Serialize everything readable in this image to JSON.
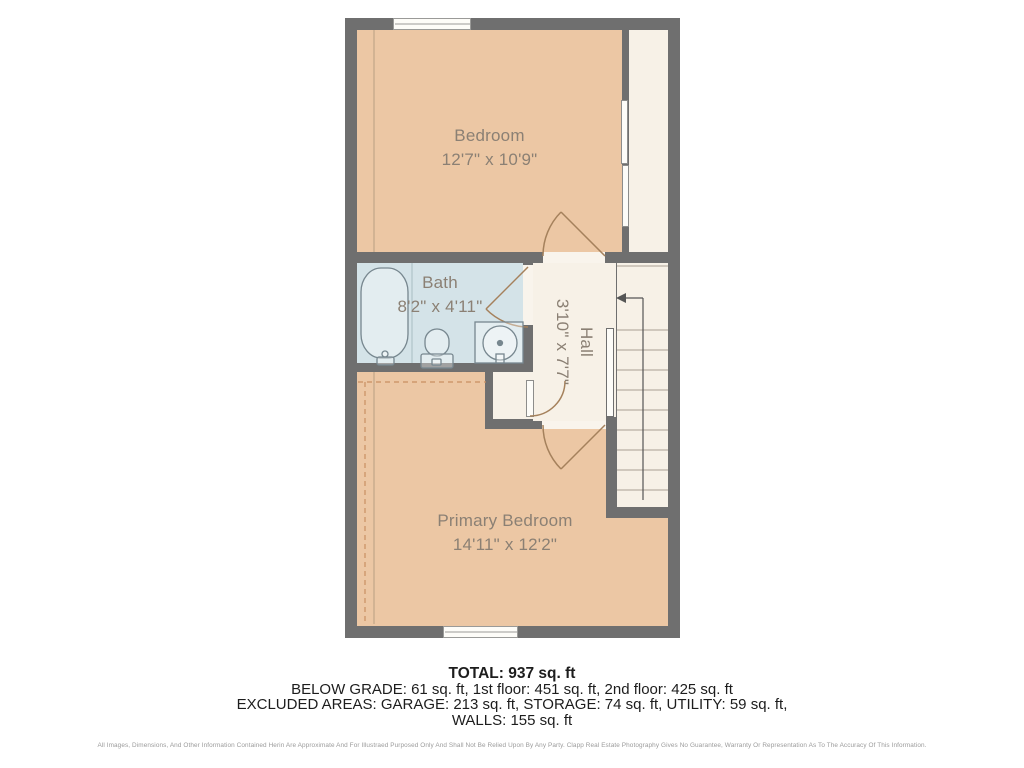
{
  "floor_plan": {
    "rooms": [
      {
        "name": "Bedroom",
        "dims": "12'7\" x 10'9\""
      },
      {
        "name": "Bath",
        "dims": "8'2\" x 4'11\""
      },
      {
        "name": "Hall",
        "dims": "3'10\" x 7'7\""
      },
      {
        "name": "Primary Bedroom",
        "dims": "14'11\" x 12'2\""
      }
    ],
    "features": [
      "stairs-with-up-arrow",
      "two-windows",
      "closet-sliding-doors",
      "bathtub",
      "toilet",
      "vanity-sink"
    ]
  },
  "summary": {
    "total": "TOTAL: 937 sq. ft",
    "floors": "BELOW GRADE: 61 sq. ft, 1st floor: 451 sq. ft, 2nd floor: 425 sq. ft",
    "excluded": "EXCLUDED AREAS: GARAGE: 213 sq. ft, STORAGE: 74 sq. ft, UTILITY: 59 sq. ft,",
    "walls": "WALLS: 155 sq. ft"
  },
  "disclaimer": "All Images, Dimensions, And Other Information Contained Herin Are Approximate And For Illustraed Purposed Only And Shall Not Be Relied Upon By Any Party. Clapp Real Estate Photography Gives No Guarantee, Warranty Or Representation As To The Accuracy Of This Information.",
  "colors": {
    "wall": "#6f6f6f",
    "bedroom_fill": "#ecc7a4",
    "bath_fill": "#d4e3e8",
    "hall_fill": "#f7f1e7",
    "door_arc": "#a5815c",
    "closet_dashed": "#c98f62",
    "label_text": "#8b8074",
    "summary_text": "#1d1d1d",
    "disclaimer_text": "#9b9b9b"
  }
}
